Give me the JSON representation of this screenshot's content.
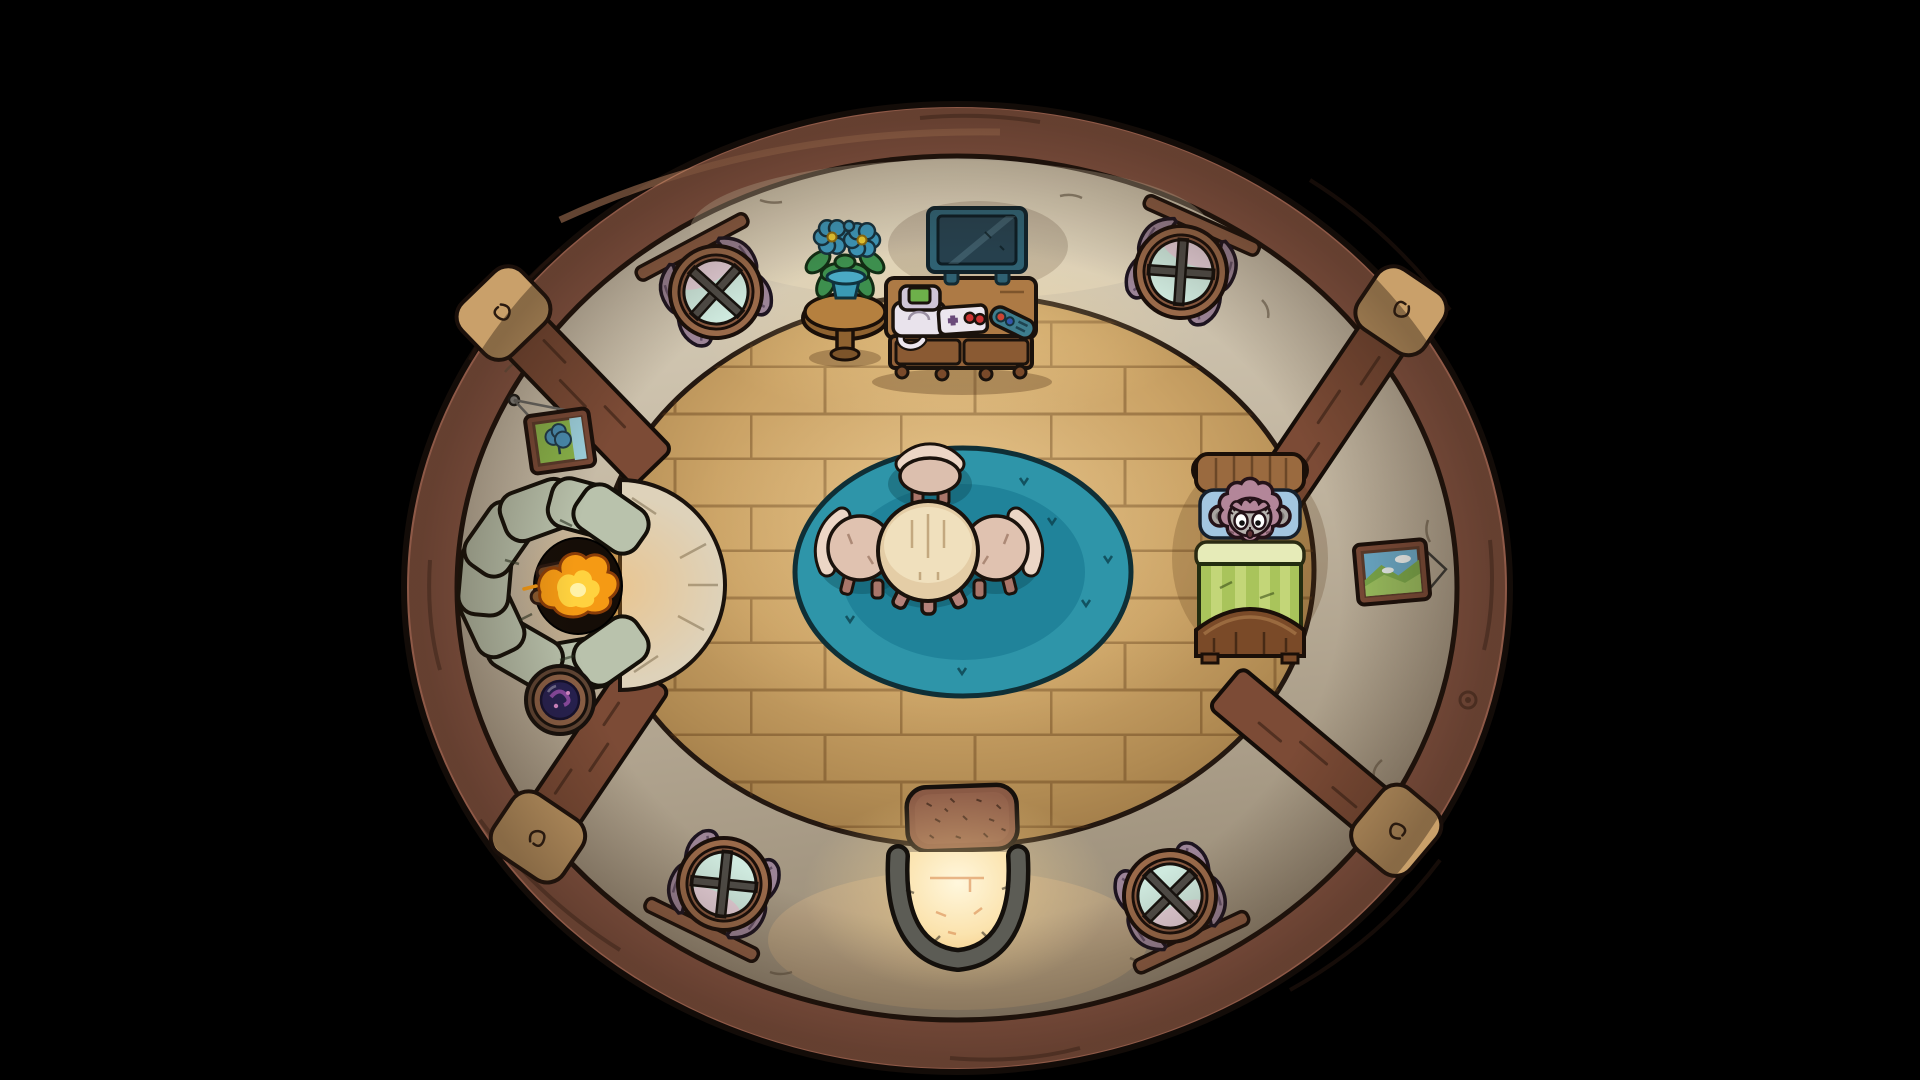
{
  "scene": {
    "description": "Top-down cartoon view of a round cottage room at night, surrounded by darkness",
    "view": "top-down",
    "room_shape": "oval",
    "objects": [
      "fireplace-lit",
      "stone-hearth",
      "tv",
      "tv-stand-with-drawers",
      "game-console",
      "game-controller",
      "remote-control",
      "potted-blue-flowers",
      "plant-stool",
      "round-window-top-left",
      "round-window-top-right",
      "round-window-bottom-left",
      "round-window-bottom-right",
      "purple-curtains",
      "wall-beams",
      "teal-rug",
      "round-table",
      "three-chairs",
      "wooden-bed",
      "character-in-bed-eyes-open",
      "green-striped-blanket",
      "blue-pillow",
      "entrance-arch-glowing",
      "door-mat",
      "picture-frame-left-tree-landscape",
      "picture-frame-right-hills-landscape",
      "porthole-ornament"
    ],
    "colors": {
      "background": "#000000",
      "wood-ring": "#8e5947",
      "stone-light": "#ded5c0",
      "stone-dark": "#998c77",
      "floor-light": "#e2bf86",
      "floor-dark": "#8f6c3e",
      "beam": "#7c4b36",
      "beam-cap": "#c9a06a",
      "rug-teal": "#2e95a9",
      "rug-teal-dark": "#20839a",
      "fire-orange": "#f59a14",
      "fire-yellow": "#ffd23f",
      "hearth": "#ded2ba",
      "fireplace-stone": "#b9c2ac",
      "curtain": "#9c8497",
      "glass": "#cfeadf",
      "tv-teal": "#2f6172",
      "blanket": "#a9c45b",
      "pillow": "#a3c6e0",
      "hair": "#b38699",
      "face": "#b7b3af",
      "door-light": "#fff7dd",
      "mat": "#8a5a45",
      "table-cream": "#f0e0bd"
    }
  }
}
